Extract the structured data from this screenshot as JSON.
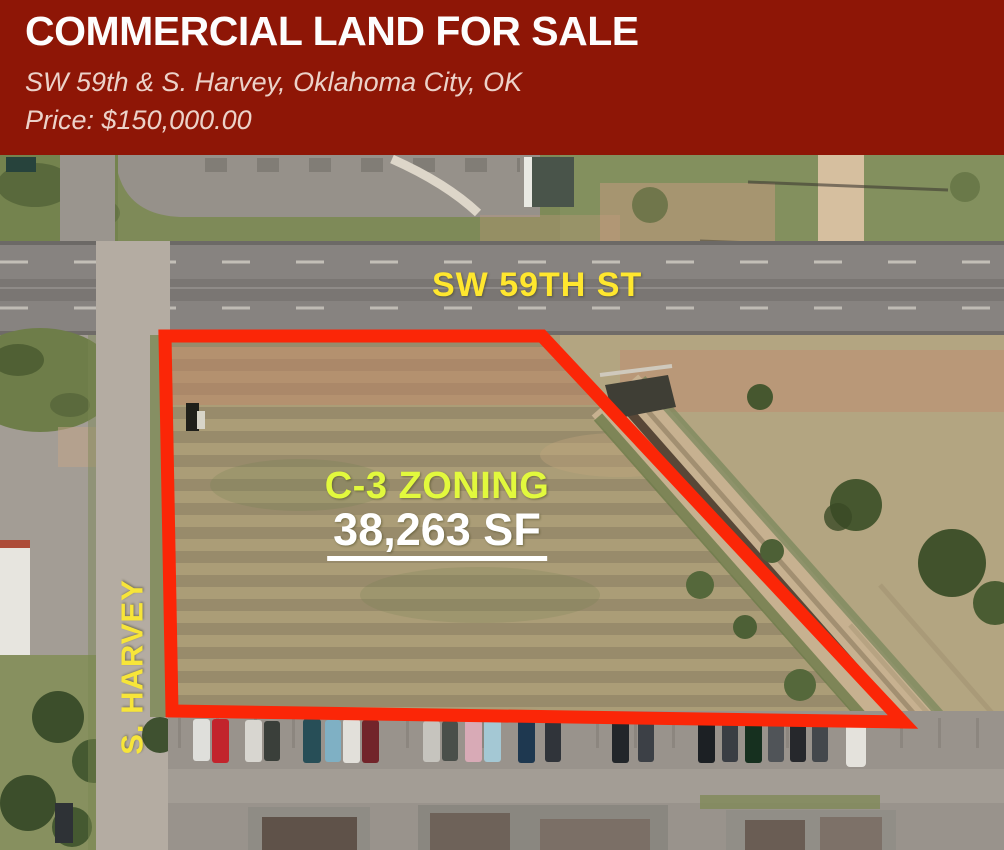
{
  "header": {
    "title": "COMMERCIAL LAND FOR SALE",
    "address": "SW 59th & S. Harvey, Oklahoma City, OK",
    "price_label": "Price: $150,000.00",
    "background_color": "#8e1606",
    "title_color": "#ffffff",
    "subtext_color": "#ecd2c9"
  },
  "map": {
    "description": "aerial satellite photo of vacant commercial parcel",
    "labels": {
      "street_horizontal": "SW 59TH ST",
      "street_vertical": "S. HARVEY",
      "zoning": "C-3 ZONING",
      "area": "38,263 SF"
    },
    "colors": {
      "parcel_outline": "#fb2607",
      "street_label": "#ffe72e",
      "zoning_label": "#e2f93d",
      "area_label": "#ffffff"
    }
  }
}
